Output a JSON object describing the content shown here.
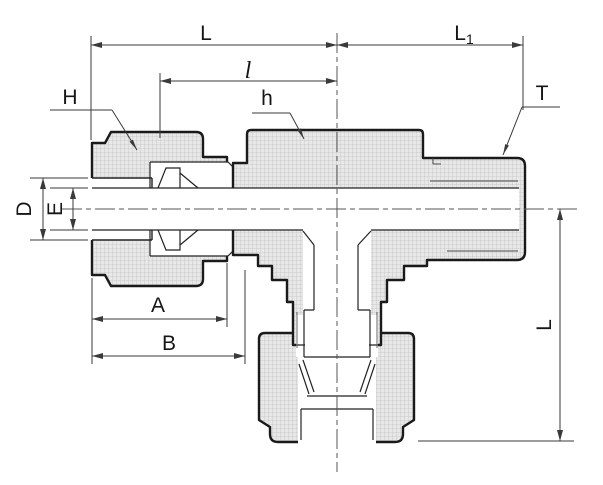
{
  "drawing": {
    "kind": "cross-section of a tee compression tube fitting",
    "labels": {
      "L_top": "L",
      "l_mid": "l",
      "L1_base": "L",
      "L1_sub": "1",
      "H_leader": "H",
      "h_leader": "h",
      "T_leader": "T",
      "D_left": "D",
      "E_left": "E",
      "A_bottom": "A",
      "B_bottom": "B",
      "L_right": "L"
    },
    "colors": {
      "background": "#ffffff",
      "outline": "#1a1a1a",
      "detail": "#222222",
      "thin": "#3a3a3a",
      "hatch_bg": "#e8e8e8",
      "hatch_line": "#c3c3c3",
      "centerline": "#555555"
    }
  }
}
